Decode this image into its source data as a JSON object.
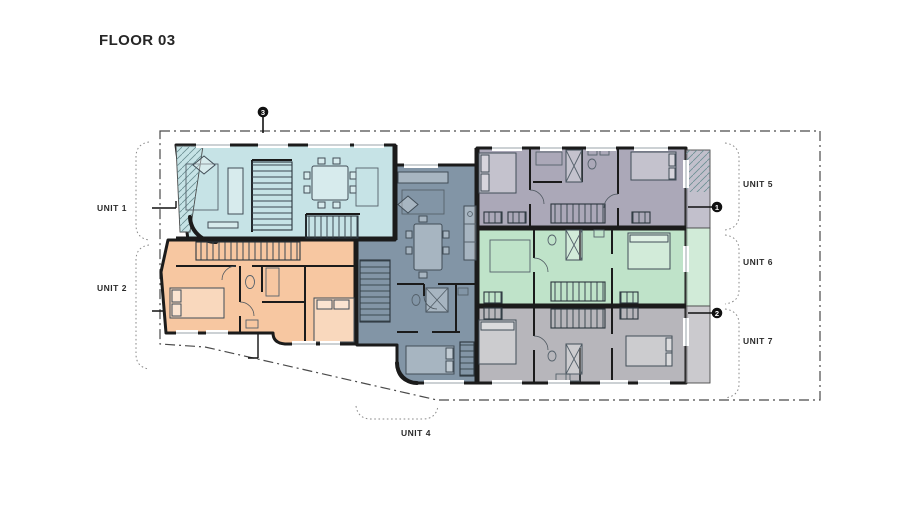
{
  "title": "FLOOR 03",
  "plan": {
    "units": [
      {
        "id": "unit-1",
        "label": "UNIT 1",
        "color": "#c6e3e6"
      },
      {
        "id": "unit-2",
        "label": "UNIT 2",
        "color": "#f7c7a1"
      },
      {
        "id": "unit-4",
        "label": "UNIT 4",
        "color": "#8295a6"
      },
      {
        "id": "unit-5",
        "label": "UNIT 5",
        "color": "#aba8b8"
      },
      {
        "id": "unit-6",
        "label": "UNIT 6",
        "color": "#bfe3c9"
      },
      {
        "id": "unit-7",
        "label": "UNIT 7",
        "color": "#b7b6bb"
      }
    ],
    "markers": [
      {
        "number": "1"
      },
      {
        "number": "2"
      },
      {
        "number": "3"
      }
    ],
    "colors": {
      "wall": "#1b1b1b",
      "boundary": "#4a4a4a",
      "furniture": "#414d57",
      "label": "#2b2b2b"
    }
  }
}
